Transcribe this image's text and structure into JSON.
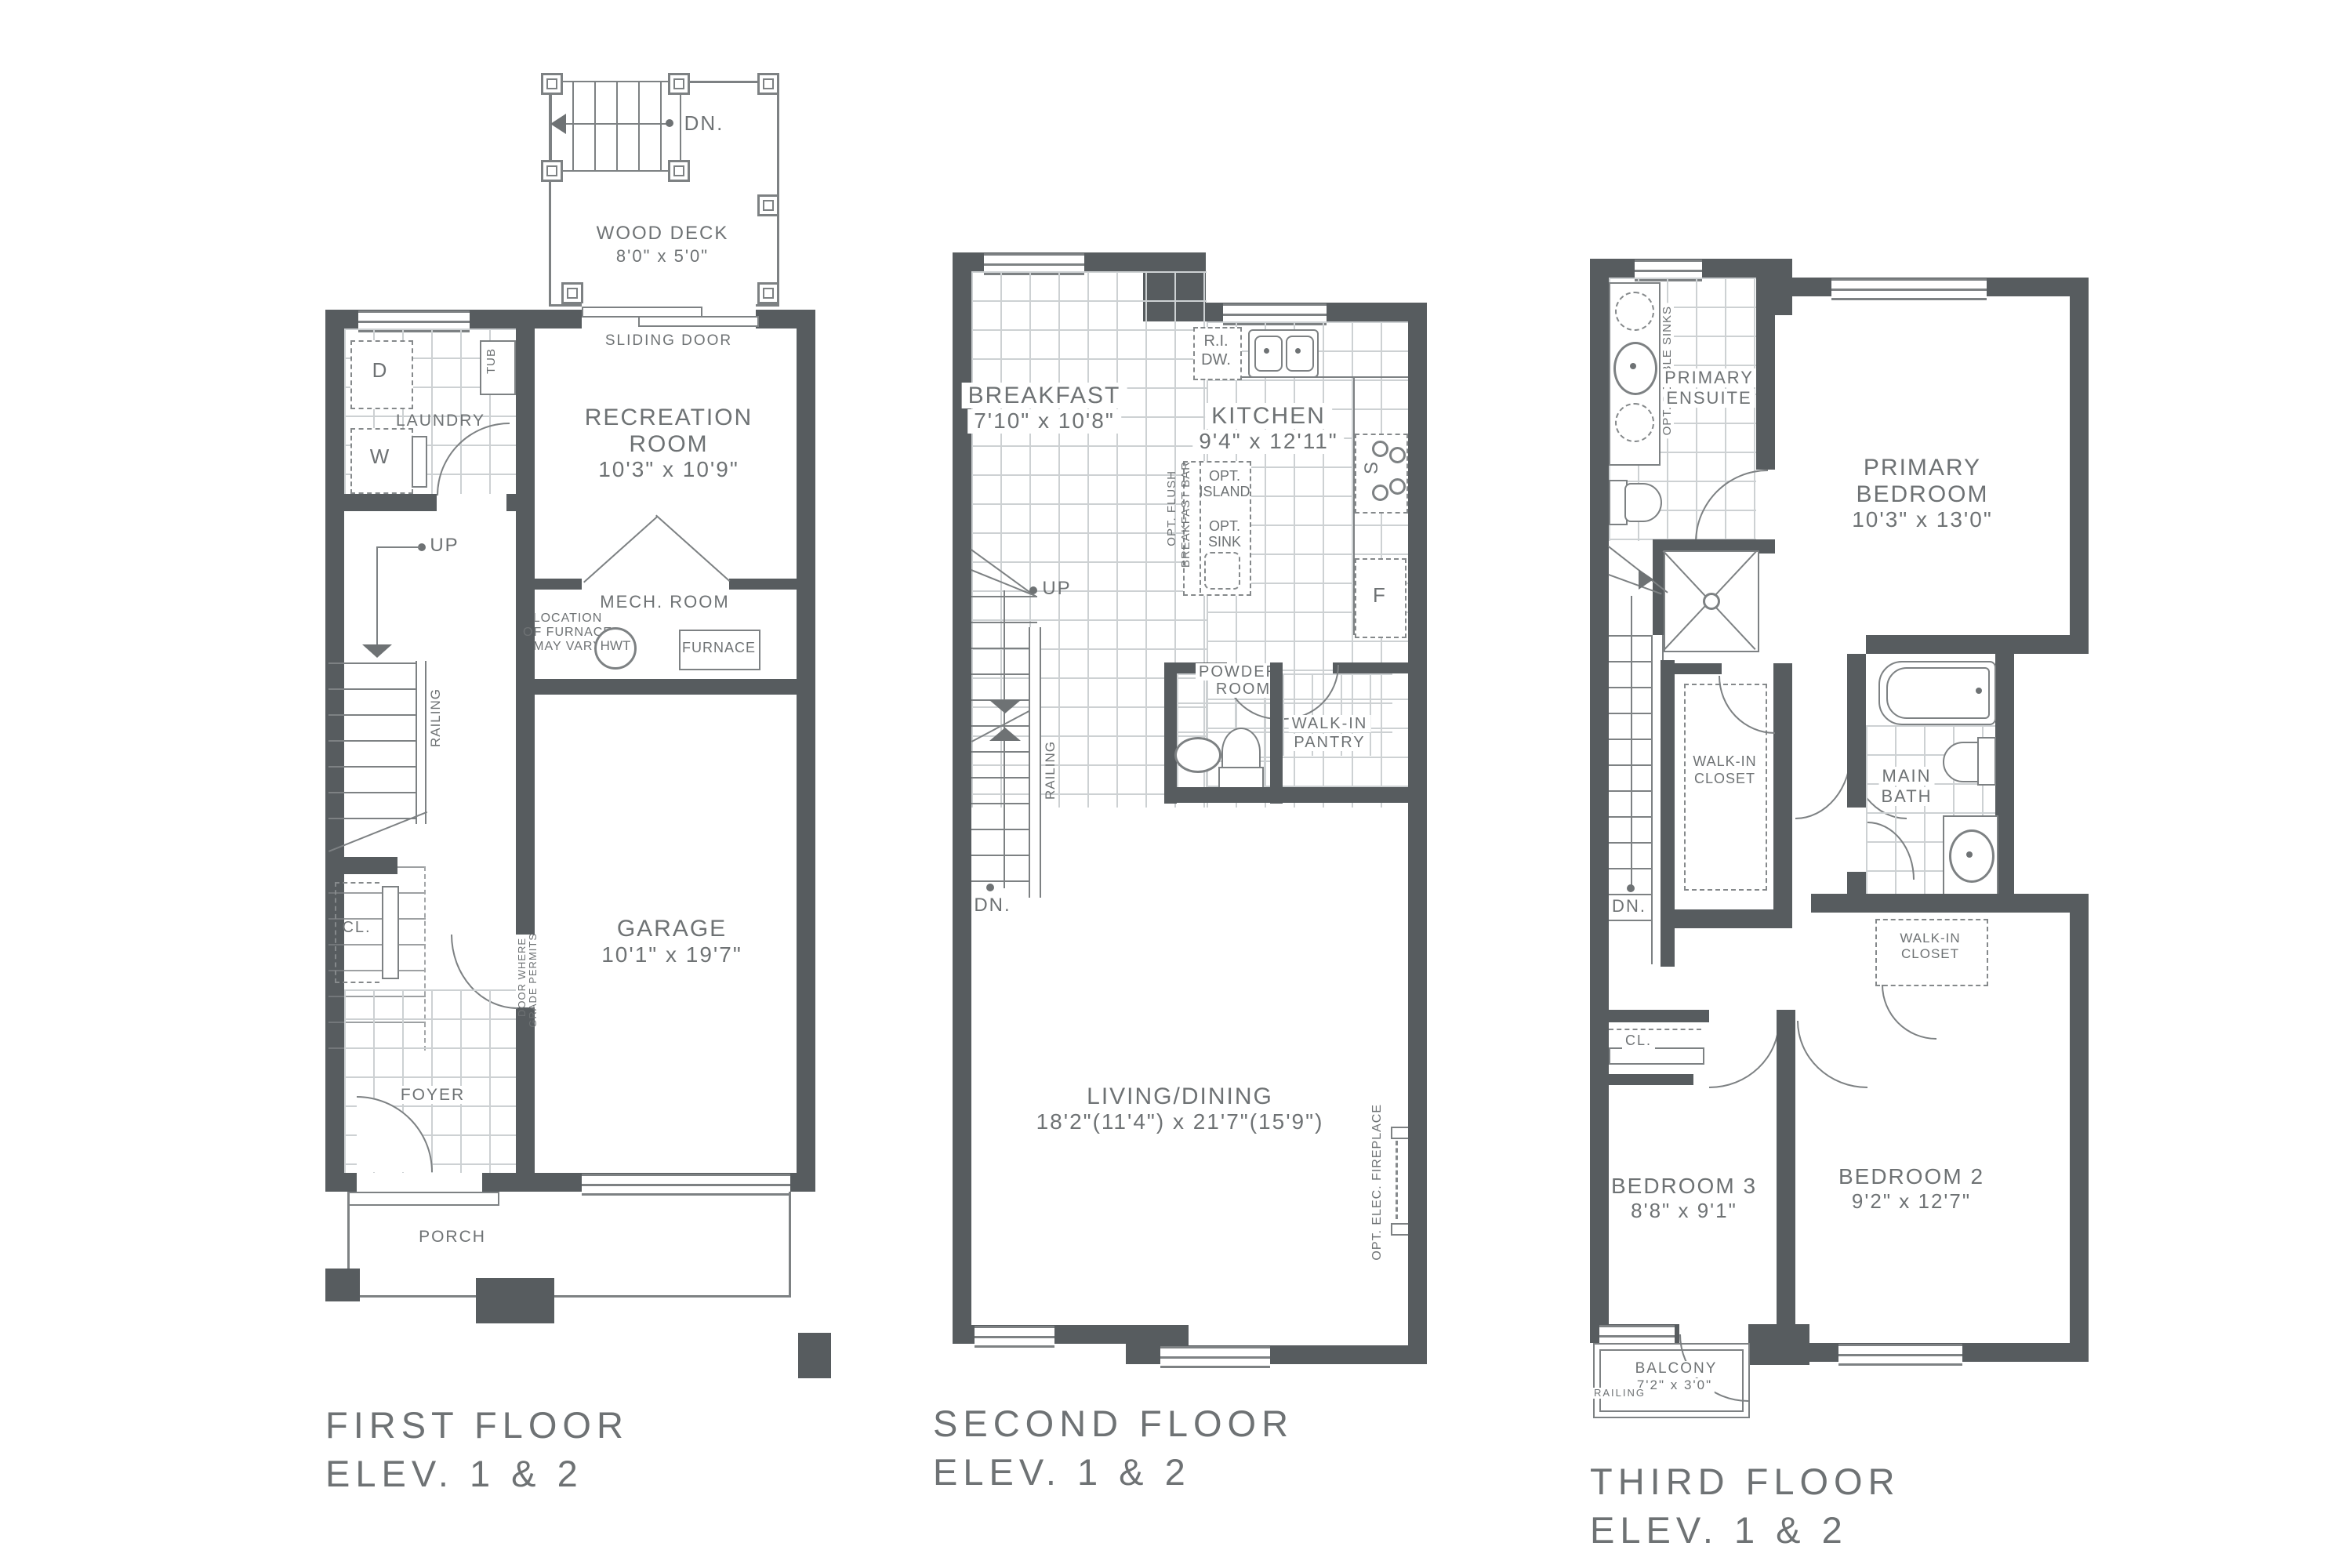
{
  "colors": {
    "wall": "#575c5f",
    "line": "#7d8183",
    "tile": "#cdd1d3",
    "text": "#6e7274",
    "background": "#ffffff"
  },
  "f1": {
    "t1": "FIRST FLOOR",
    "t2": "ELEV. 1 & 2",
    "dn": "DN.",
    "wood_deck": "WOOD DECK",
    "wood_deck_dims": "8'0\" x 5'0\"",
    "sliding_door": "SLIDING DOOR",
    "dryer": "D",
    "washer": "W",
    "tub": "TUB",
    "laundry": "LAUNDRY",
    "rec1": "RECREATION",
    "rec2": "ROOM",
    "rec_dims": "10'3\" x 10'9\"",
    "up": "UP",
    "railing": "RAILING",
    "mech": "MECH. ROOM",
    "fn1": "LOCATION",
    "fn2": "OF FURNACE",
    "fn3": "MAY VARY",
    "hwt": "HWT",
    "furnace": "FURNACE",
    "garage": "GARAGE",
    "garage_dims": "10'1\" x 19'7\"",
    "grade1": "DOOR WHERE",
    "grade2": "GRADE PERMITS",
    "cl": "CL.",
    "foyer": "FOYER",
    "porch": "PORCH"
  },
  "f2": {
    "t1": "SECOND FLOOR",
    "t2": "ELEV. 1 & 2",
    "breakfast": "BREAKFAST",
    "breakfast_dims": "7'10\" x 10'8\"",
    "kitchen": "KITCHEN",
    "kitchen_dims": "9'4\" x 12'11\"",
    "ri1": "R.I.",
    "ri2": "DW.",
    "stove": "S",
    "fridge": "F",
    "oi1": "OPT.",
    "oi2": "ISLAND",
    "os1": "OPT.",
    "os2": "SINK",
    "bar1": "OPT. FLUSH",
    "bar2": "BREAKFAST BAR",
    "up": "UP",
    "dn": "DN.",
    "railing": "RAILING",
    "pw1": "POWDER",
    "pw2": "ROOM",
    "pan1": "WALK-IN",
    "pan2": "PANTRY",
    "living": "LIVING/DINING",
    "living_dims": "18'2\"(11'4\") x 21'7\"(15'9\")",
    "fire": "OPT. ELEC. FIREPLACE"
  },
  "f3": {
    "t1": "THIRD FLOOR",
    "t2": "ELEV. 1 & 2",
    "ods": "OPT. DOUBLE SINKS",
    "en1": "PRIMARY",
    "en2": "ENSUITE",
    "pb1": "PRIMARY",
    "pb2": "BEDROOM",
    "pb_dims": "10'3\" x 13'0\"",
    "dn": "DN.",
    "wc1a": "WALK-IN",
    "wc1b": "CLOSET",
    "mb1": "MAIN",
    "mb2": "BATH",
    "wc2a": "WALK-IN",
    "wc2b": "CLOSET",
    "cl": "CL.",
    "b3": "BEDROOM 3",
    "b3_dims": "8'8\" x 9'1\"",
    "b2": "BEDROOM 2",
    "b2_dims": "9'2\" x 12'7\"",
    "balcony": "BALCONY",
    "balcony_dims": "7'2\" x 3'0\"",
    "railing": "RAILING"
  }
}
